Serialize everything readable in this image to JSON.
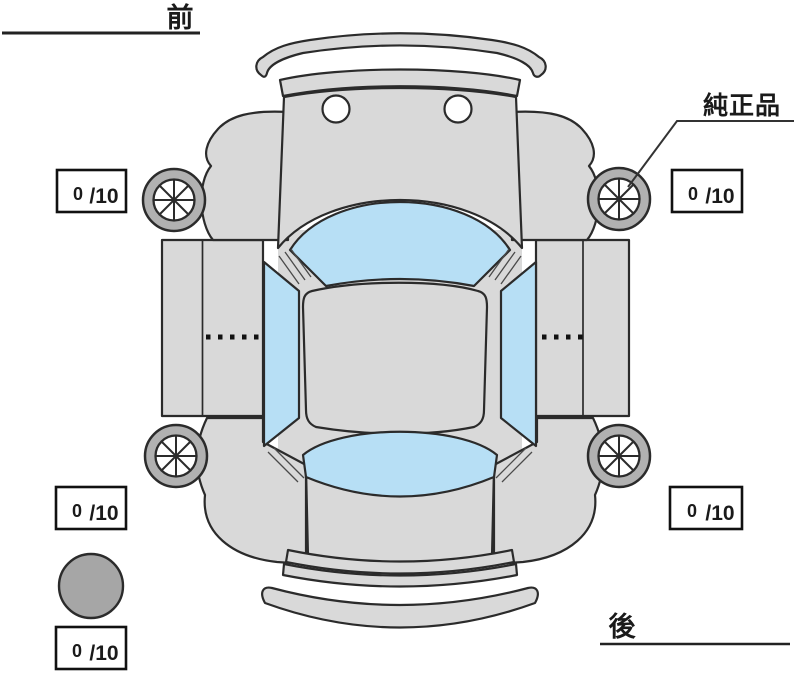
{
  "labels": {
    "front": "前",
    "rear": "後",
    "genuine_part": "純正品"
  },
  "tread": {
    "front_left": {
      "value": "0",
      "denom": "/10"
    },
    "front_right": {
      "value": "0",
      "denom": "/10"
    },
    "rear_left": {
      "value": "0",
      "denom": "/10"
    },
    "rear_right": {
      "value": "0",
      "denom": "/10"
    },
    "spare": {
      "value": "0",
      "denom": "/10"
    }
  },
  "colors": {
    "bg": "#ffffff",
    "body": "#d9d9d9",
    "glass": "#b7dff5",
    "wheel": "#b1b1b1",
    "spare": "#a6a6a6",
    "outline": "#2b2b2b"
  }
}
